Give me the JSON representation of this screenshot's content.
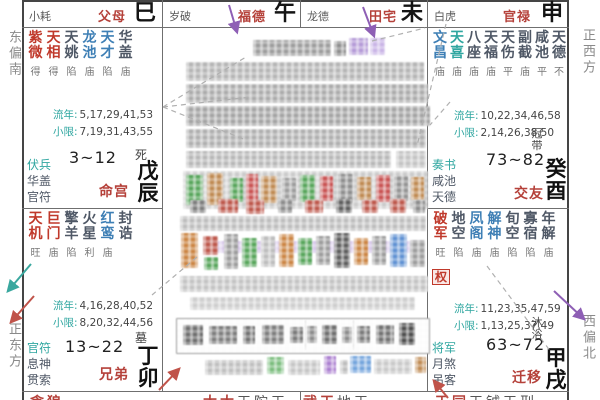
{
  "palette": {
    "major_star_red": "#c0392b",
    "lucky_star_blue": "#3e7fb5",
    "deity_teal": "#2fa6a0",
    "minor_star_dark": "#4f5866",
    "palace_name_red": "#b5413a",
    "arrow_purple": "#8e5fb5",
    "arrow_teal": "#3aa89f",
    "arrow_red": "#c0534a"
  },
  "margin_labels": {
    "east_south": "东偏南",
    "east": "正东方",
    "west": "正西方",
    "west_north": "西偏北"
  },
  "labels": {
    "liunian": "流年:",
    "xiaoxian": "小限:"
  },
  "top_strip": [
    {
      "deity": "小耗",
      "palace": "父母",
      "branch": "巳"
    },
    {
      "deity": "岁破",
      "palace": "福德",
      "branch": "午"
    },
    {
      "deity": "龙德",
      "palace": "田宅",
      "branch": "未"
    },
    {
      "deity": "白虎",
      "palace": "官禄",
      "branch": "申"
    }
  ],
  "palaces": {
    "chen": {
      "stars": [
        {
          "n": "紫微",
          "b": "得",
          "c": "r"
        },
        {
          "n": "天相",
          "b": "得",
          "c": "r"
        },
        {
          "n": "天姚",
          "b": "陷",
          "c": "d"
        },
        {
          "n": "龙池",
          "b": "庙",
          "c": "b"
        },
        {
          "n": "天才",
          "b": "陷",
          "c": "b"
        },
        {
          "n": "华盖",
          "b": "庙",
          "c": "d"
        }
      ],
      "liunian": "5,17,29,41,53",
      "xiaoxian": "7,19,31,43,55",
      "deities": [
        "伏兵",
        "华盖",
        "官符"
      ],
      "age": "3~12",
      "name": "命宫",
      "stage": "死",
      "ganzhi": "戊辰"
    },
    "mao": {
      "stars": [
        {
          "n": "天机",
          "b": "旺",
          "c": "r"
        },
        {
          "n": "巨门",
          "b": "庙",
          "c": "r"
        },
        {
          "n": "擎羊",
          "b": "陷",
          "c": "d"
        },
        {
          "n": "火星",
          "b": "利",
          "c": "d"
        },
        {
          "n": "红鸾",
          "b": "庙",
          "c": "b"
        },
        {
          "n": "封诰",
          "b": "",
          "c": "d"
        }
      ],
      "liunian": "4,16,28,40,52",
      "xiaoxian": "8,20,32,44,56",
      "deities": [
        "官符",
        "息神",
        "贯索"
      ],
      "age": "13~22",
      "name": "兄弟",
      "stage": "墓",
      "ganzhi": "丁卯"
    },
    "you": {
      "stars": [
        {
          "n": "文昌",
          "b": "庙",
          "c": "b"
        },
        {
          "n": "天喜",
          "b": "庙",
          "c": "t"
        },
        {
          "n": "八座",
          "b": "庙",
          "c": "d"
        },
        {
          "n": "天福",
          "b": "庙",
          "c": "d"
        },
        {
          "n": "天伤",
          "b": "平",
          "c": "d"
        },
        {
          "n": "副截",
          "b": "庙",
          "c": "d"
        },
        {
          "n": "咸池",
          "b": "平",
          "c": "d"
        },
        {
          "n": "天德",
          "b": "不",
          "c": "d"
        }
      ],
      "liunian": "10,22,34,46,58",
      "xiaoxian": "2,14,26,38,50",
      "deities": [
        "奏书",
        "咸池",
        "天德"
      ],
      "age": "73~82",
      "name": "交友",
      "stage": "冠带",
      "ganzhi": "癸酉"
    },
    "xu": {
      "stars": [
        {
          "n": "破军",
          "b": "旺",
          "c": "r"
        },
        {
          "n": "地空",
          "b": "陷",
          "c": "d"
        },
        {
          "n": "凤阁",
          "b": "庙",
          "c": "b"
        },
        {
          "n": "解神",
          "b": "庙",
          "c": "b"
        },
        {
          "n": "旬空",
          "b": "陷",
          "c": "d"
        },
        {
          "n": "寡宿",
          "b": "陷",
          "c": "d"
        },
        {
          "n": "年解",
          "b": "庙",
          "c": "d"
        }
      ],
      "hua": "权",
      "liunian": "11,23,35,47,59",
      "xiaoxian": "1,13,25,37,49",
      "deities": [
        "将军",
        "月煞",
        "吊客"
      ],
      "age": "63~72",
      "name": "迁移",
      "stage": "沐浴",
      "ganzhi": "甲戌"
    }
  },
  "bottom_strip": [
    {
      "major": "贪狼",
      "minor": ""
    },
    {
      "major": "太太",
      "minor": "天陀天"
    },
    {
      "major": "武天",
      "minor": "地天"
    },
    {
      "major": "天同",
      "minor": "天钺天刑"
    }
  ],
  "redaction_blocks": [
    [
      253,
      40,
      78,
      16,
      "#9c9c9c"
    ],
    [
      334,
      41,
      12,
      15,
      "#8d8d8d"
    ],
    [
      349,
      38,
      19,
      17,
      "#b49ad7"
    ],
    [
      370,
      38,
      15,
      17,
      "#c9b4e6"
    ],
    [
      186,
      62,
      238,
      19,
      "#b4b4b4"
    ],
    [
      186,
      84,
      242,
      19,
      "#ababab"
    ],
    [
      186,
      106,
      244,
      20,
      "#a3a3a3"
    ],
    [
      186,
      129,
      240,
      19,
      "#aeaeae"
    ],
    [
      186,
      151,
      205,
      17,
      "#b7b7b7"
    ],
    [
      396,
      151,
      30,
      17,
      "#c2c2c2"
    ],
    [
      183,
      171,
      245,
      38,
      "#cacaca"
    ],
    [
      186,
      175,
      17,
      30,
      "#57a55b"
    ],
    [
      207,
      173,
      16,
      32,
      "#bf8a52"
    ],
    [
      230,
      178,
      13,
      24,
      "#57a55b"
    ],
    [
      246,
      174,
      12,
      28,
      "#c85252"
    ],
    [
      261,
      176,
      16,
      27,
      "#bf8a52"
    ],
    [
      282,
      178,
      14,
      23,
      "#9c9c9c"
    ],
    [
      300,
      175,
      15,
      27,
      "#57a55b"
    ],
    [
      320,
      176,
      13,
      25,
      "#c85252"
    ],
    [
      338,
      174,
      15,
      29,
      "#8d8d8d"
    ],
    [
      357,
      177,
      14,
      23,
      "#bf8a52"
    ],
    [
      376,
      175,
      14,
      27,
      "#c85252"
    ],
    [
      394,
      176,
      14,
      25,
      "#939393"
    ],
    [
      411,
      177,
      13,
      23,
      "#bf8a52"
    ],
    [
      190,
      200,
      16,
      13,
      "#7d7d7d"
    ],
    [
      218,
      199,
      20,
      14,
      "#bd564a"
    ],
    [
      246,
      200,
      18,
      14,
      "#bd564a"
    ],
    [
      278,
      199,
      14,
      14,
      "#8b8b8b"
    ],
    [
      305,
      200,
      18,
      13,
      "#bd564a"
    ],
    [
      336,
      199,
      16,
      14,
      "#5d5d5d"
    ],
    [
      362,
      200,
      16,
      13,
      "#bd564a"
    ],
    [
      390,
      199,
      16,
      14,
      "#bd564a"
    ],
    [
      413,
      200,
      12,
      13,
      "#8b8b8b"
    ],
    [
      180,
      216,
      246,
      15,
      "#bdbdbd"
    ],
    [
      205,
      241,
      218,
      12,
      "#d9c9ec"
    ],
    [
      181,
      233,
      17,
      35,
      "#cb8544"
    ],
    [
      203,
      236,
      15,
      19,
      "#bd564a"
    ],
    [
      204,
      257,
      14,
      13,
      "#57a55b"
    ],
    [
      224,
      234,
      14,
      35,
      "#9c9c9c"
    ],
    [
      242,
      238,
      15,
      29,
      "#57a55b"
    ],
    [
      261,
      236,
      14,
      31,
      "#bcbcbc"
    ],
    [
      279,
      234,
      15,
      33,
      "#cb8544"
    ],
    [
      298,
      238,
      14,
      27,
      "#57a55b"
    ],
    [
      316,
      236,
      14,
      29,
      "#9c9c9c"
    ],
    [
      334,
      233,
      16,
      35,
      "#5d5d5d"
    ],
    [
      354,
      238,
      14,
      27,
      "#cb8544"
    ],
    [
      372,
      236,
      14,
      29,
      "#9c9c9c"
    ],
    [
      390,
      234,
      17,
      33,
      "#5e90d2"
    ],
    [
      410,
      240,
      15,
      27,
      "#9c9c9c"
    ],
    [
      180,
      276,
      248,
      16,
      "#c3c3c3"
    ],
    [
      190,
      297,
      225,
      13,
      "#cdcdcd"
    ],
    [
      176,
      318,
      252,
      34,
      "#fcfcfc",
      1
    ],
    [
      183,
      325,
      20,
      20,
      "#6d6d6d"
    ],
    [
      209,
      326,
      28,
      18,
      "#7d7d7d"
    ],
    [
      243,
      326,
      12,
      18,
      "#717171"
    ],
    [
      262,
      325,
      22,
      19,
      "#7d7d7d"
    ],
    [
      290,
      327,
      13,
      16,
      "#797979"
    ],
    [
      307,
      326,
      10,
      17,
      "#8b8b8b"
    ],
    [
      322,
      325,
      15,
      19,
      "#6d6d6d"
    ],
    [
      342,
      327,
      10,
      16,
      "#8b8b8b"
    ],
    [
      357,
      326,
      13,
      17,
      "#797979"
    ],
    [
      376,
      325,
      18,
      19,
      "#717171"
    ],
    [
      399,
      323,
      16,
      22,
      "#4c4c4c"
    ],
    [
      305,
      320,
      1,
      30,
      "#c6c6c6"
    ],
    [
      353,
      320,
      1,
      30,
      "#c6c6c6"
    ],
    [
      205,
      360,
      58,
      15,
      "#bfbfbf"
    ],
    [
      267,
      357,
      17,
      17,
      "#7abd7d"
    ],
    [
      288,
      360,
      32,
      15,
      "#c5c5c5"
    ],
    [
      324,
      356,
      12,
      18,
      "#ab7fd0"
    ],
    [
      340,
      360,
      8,
      14,
      "#bdbdbd"
    ],
    [
      350,
      356,
      21,
      17,
      "#73a4dc"
    ],
    [
      374,
      359,
      38,
      15,
      "#c8c8c8"
    ],
    [
      415,
      357,
      11,
      16,
      "#bf8a52"
    ]
  ]
}
